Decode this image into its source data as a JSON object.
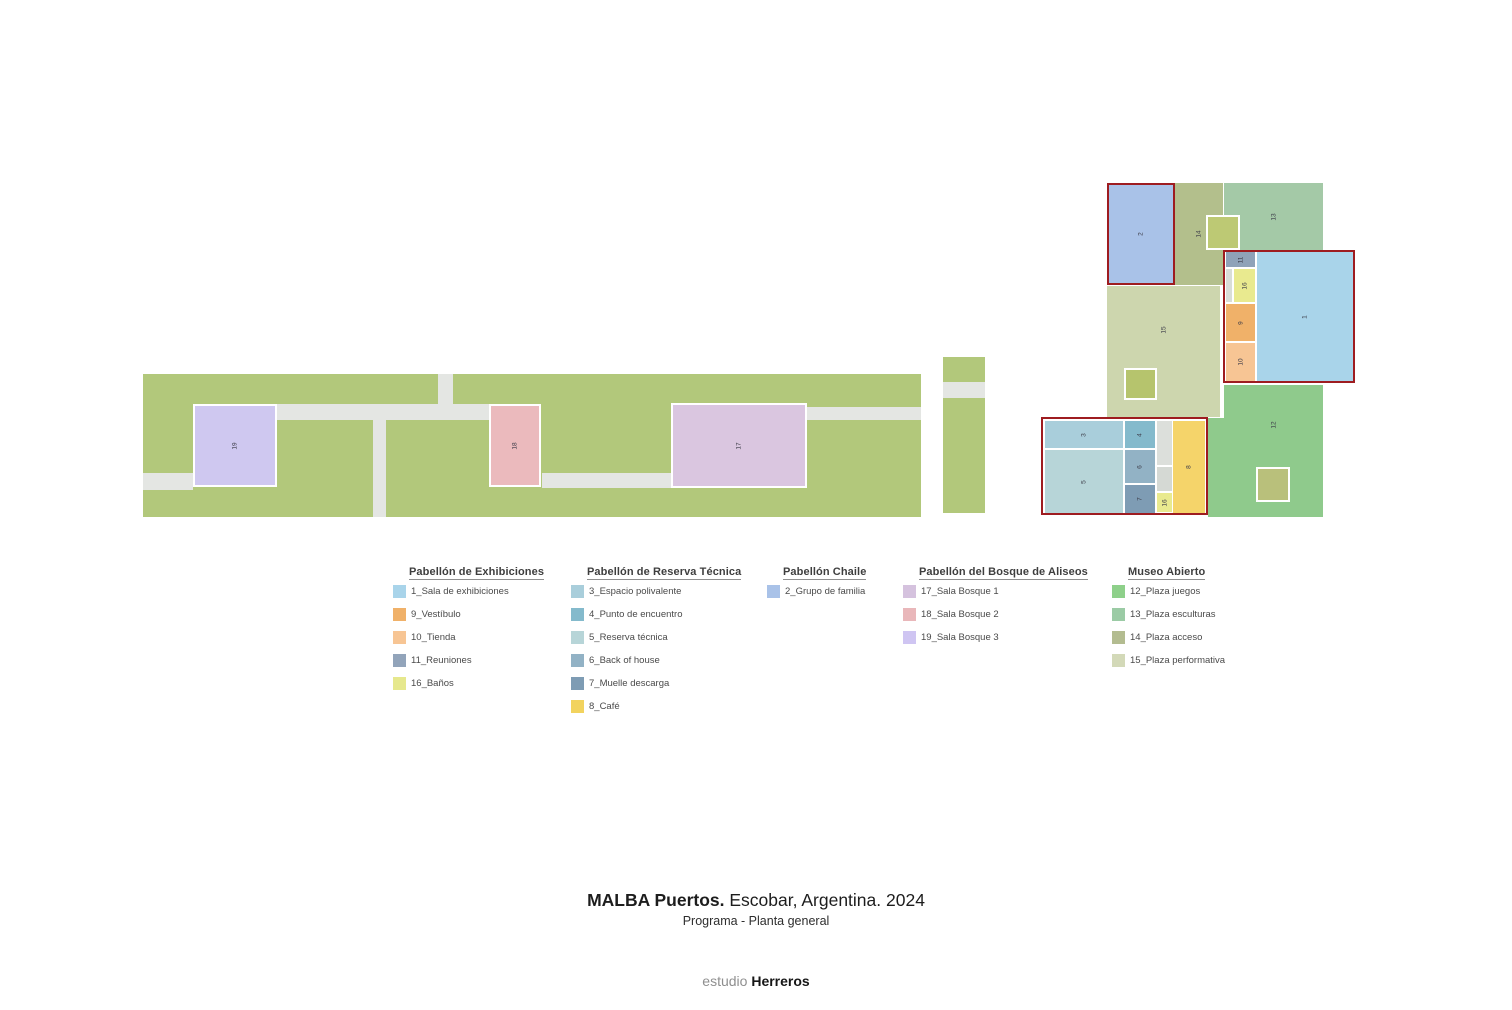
{
  "colors": {
    "bar_green": "#b2c87b",
    "path_gray": "#e4e6e3",
    "red_border": "#9e1c20",
    "white_border": "#ffffff"
  },
  "plan": {
    "rects": [
      {
        "name": "park-bar-main",
        "x": 143,
        "y": 374,
        "w": 778,
        "h": 143,
        "fill": "#b2c87b"
      },
      {
        "name": "path-horizontal-1",
        "x": 277,
        "y": 404,
        "w": 213,
        "h": 16,
        "fill": "#e4e6e3"
      },
      {
        "name": "path-horizontal-2",
        "x": 807,
        "y": 407,
        "w": 114,
        "h": 13,
        "fill": "#e4e6e3"
      },
      {
        "name": "path-horizontal-3",
        "x": 542,
        "y": 473,
        "w": 129,
        "h": 15,
        "fill": "#e4e6e3"
      },
      {
        "name": "path-vertical-1",
        "x": 373,
        "y": 420,
        "w": 13,
        "h": 97,
        "fill": "#e4e6e3"
      },
      {
        "name": "path-vertical-2",
        "x": 438,
        "y": 374,
        "w": 15,
        "h": 46,
        "fill": "#e4e6e3"
      },
      {
        "name": "path-stub-left",
        "x": 143,
        "y": 473,
        "w": 50,
        "h": 17,
        "fill": "#e4e6e3"
      },
      {
        "name": "block-sala-bosque-3",
        "x": 193,
        "y": 404,
        "w": 84,
        "h": 83,
        "fill": "#cfc8f0",
        "border": "white",
        "label": "19"
      },
      {
        "name": "block-sala-bosque-2",
        "x": 489,
        "y": 404,
        "w": 52,
        "h": 83,
        "fill": "#ebbabd",
        "border": "white",
        "label": "18"
      },
      {
        "name": "block-sala-bosque-1",
        "x": 671,
        "y": 403,
        "w": 136,
        "h": 85,
        "fill": "#dac6e0",
        "border": "white",
        "label": "17"
      },
      {
        "name": "park-strip-top",
        "x": 943,
        "y": 357,
        "w": 42,
        "h": 25,
        "fill": "#b2c87b"
      },
      {
        "name": "park-strip-gap",
        "x": 943,
        "y": 382,
        "w": 42,
        "h": 16,
        "fill": "#e4e6e3"
      },
      {
        "name": "park-strip-tall",
        "x": 943,
        "y": 398,
        "w": 42,
        "h": 115,
        "fill": "#b2c87b"
      },
      {
        "name": "block-plaza-acceso",
        "x": 1174,
        "y": 183,
        "w": 49,
        "h": 102,
        "fill": "#b3bf8c",
        "label": "14"
      },
      {
        "name": "block-plaza-esculturas",
        "x": 1224,
        "y": 183,
        "w": 99,
        "h": 67,
        "fill": "#a4c9a7",
        "label": "13"
      },
      {
        "name": "block-plaza-performativa",
        "x": 1107,
        "y": 286,
        "w": 113,
        "h": 131,
        "fill": "#cdd6ae",
        "label": "15",
        "label_dy": -22
      },
      {
        "name": "block-plaza-juegos",
        "x": 1224,
        "y": 385,
        "w": 99,
        "h": 132,
        "fill": "#8fca8c",
        "label": "12",
        "label_dy": -26
      },
      {
        "name": "block-plaza-juegos-ext",
        "x": 1208,
        "y": 418,
        "w": 16,
        "h": 99,
        "fill": "#8fca8c"
      },
      {
        "name": "square-plaza-acceso",
        "x": 1206,
        "y": 215,
        "w": 34,
        "h": 35,
        "fill": "#bdc974",
        "border": "white"
      },
      {
        "name": "square-plaza-performativa",
        "x": 1124,
        "y": 368,
        "w": 33,
        "h": 32,
        "fill": "#b6c46d",
        "border": "white"
      },
      {
        "name": "square-plaza-juegos",
        "x": 1256,
        "y": 467,
        "w": 34,
        "h": 35,
        "fill": "#b9c07b",
        "border": "white"
      },
      {
        "name": "block-grupo-de-familia",
        "x": 1107,
        "y": 183,
        "w": 68,
        "h": 102,
        "fill": "#a9c2e8",
        "border": "red",
        "label": "2"
      },
      {
        "name": "block-reuniones",
        "x": 1226,
        "y": 252,
        "w": 29,
        "h": 15,
        "fill": "#8fa2b8",
        "label": "11"
      },
      {
        "name": "hall-gray-sliver",
        "x": 1226,
        "y": 269,
        "w": 6,
        "h": 33,
        "fill": "#d9ddd8"
      },
      {
        "name": "block-banos-norte",
        "x": 1234,
        "y": 269,
        "w": 21,
        "h": 33,
        "fill": "#e9ea8f",
        "label": "16"
      },
      {
        "name": "block-vestibulo",
        "x": 1226,
        "y": 304,
        "w": 29,
        "h": 37,
        "fill": "#f0b169",
        "label": "9"
      },
      {
        "name": "block-tienda",
        "x": 1226,
        "y": 343,
        "w": 29,
        "h": 38,
        "fill": "#f7c594",
        "label": "10"
      },
      {
        "name": "block-sala-exhibiciones",
        "x": 1257,
        "y": 252,
        "w": 96,
        "h": 129,
        "fill": "#a9d4ea",
        "label": "1"
      },
      {
        "name": "redbox-pabellon-exhibiciones",
        "x": 1223,
        "y": 250,
        "w": 132,
        "h": 133,
        "fill": "none",
        "border": "red"
      },
      {
        "name": "block-espacio-polivalente",
        "x": 1045,
        "y": 421,
        "w": 78,
        "h": 27,
        "fill": "#a9cedb",
        "label": "3"
      },
      {
        "name": "block-punto-encuentro",
        "x": 1125,
        "y": 421,
        "w": 30,
        "h": 27,
        "fill": "#84bacc",
        "label": "4"
      },
      {
        "name": "block-reserva-tecnica",
        "x": 1045,
        "y": 450,
        "w": 78,
        "h": 63,
        "fill": "#b7d5d8",
        "label": "5"
      },
      {
        "name": "block-back-of-house",
        "x": 1125,
        "y": 450,
        "w": 30,
        "h": 33,
        "fill": "#92b2c5",
        "label": "6"
      },
      {
        "name": "block-muelle-descarga",
        "x": 1125,
        "y": 485,
        "w": 30,
        "h": 28,
        "fill": "#7e9cb4",
        "label": "7"
      },
      {
        "name": "reserva-gray-a",
        "x": 1157,
        "y": 421,
        "w": 15,
        "h": 44,
        "fill": "#dcdfdb"
      },
      {
        "name": "reserva-gray-b",
        "x": 1157,
        "y": 467,
        "w": 15,
        "h": 24,
        "fill": "#d5d9d4"
      },
      {
        "name": "block-banos-sur",
        "x": 1157,
        "y": 493,
        "w": 15,
        "h": 19,
        "fill": "#e9ea8f",
        "label": "16"
      },
      {
        "name": "block-cafe",
        "x": 1173,
        "y": 421,
        "w": 32,
        "h": 92,
        "fill": "#f5d46a",
        "label": "8"
      },
      {
        "name": "redbox-pabellon-reserva",
        "x": 1041,
        "y": 417,
        "w": 167,
        "h": 98,
        "fill": "none",
        "border": "red"
      }
    ]
  },
  "legend": {
    "columns": [
      {
        "title": "Pabellón de Exhibiciones",
        "left": 393,
        "items": [
          {
            "label": "1_Sala de exhibiciones",
            "color": "#a9d4ea"
          },
          {
            "label": "9_Vestíbulo",
            "color": "#f0b169"
          },
          {
            "label": "10_Tienda",
            "color": "#f7c594"
          },
          {
            "label": "11_Reuniones",
            "color": "#92a4ba"
          },
          {
            "label": "16_Baños",
            "color": "#e6e88d"
          }
        ]
      },
      {
        "title": "Pabellón de Reserva Técnica",
        "left": 571,
        "items": [
          {
            "label": "3_Espacio polivalente",
            "color": "#a9cedb"
          },
          {
            "label": "4_Punto de encuentro",
            "color": "#84bacc"
          },
          {
            "label": "5_Reserva técnica",
            "color": "#b7d5d8"
          },
          {
            "label": "6_Back of house",
            "color": "#92b2c5"
          },
          {
            "label": "7_Muelle descarga",
            "color": "#7e9cb4"
          },
          {
            "label": "8_Café",
            "color": "#f2d35e"
          }
        ]
      },
      {
        "title": "Pabellón Chaile",
        "left": 767,
        "items": [
          {
            "label": "2_Grupo de familia",
            "color": "#a9c2e8"
          }
        ]
      },
      {
        "title": "Pabellón del Bosque de Aliseos",
        "left": 903,
        "items": [
          {
            "label": "17_Sala Bosque 1",
            "color": "#d5c2de"
          },
          {
            "label": "18_Sala Bosque 2",
            "color": "#e9b7ba"
          },
          {
            "label": "19_Sala Bosque 3",
            "color": "#cfc5f2"
          }
        ]
      },
      {
        "title": "Museo Abierto",
        "left": 1112,
        "items": [
          {
            "label": "12_Plaza juegos",
            "color": "#8ed08a"
          },
          {
            "label": "13_Plaza esculturas",
            "color": "#9bcba5"
          },
          {
            "label": "14_Plaza acceso",
            "color": "#b3bc90"
          },
          {
            "label": "15_Plaza performativa",
            "color": "#d3d9b8"
          }
        ]
      }
    ]
  },
  "title": {
    "bold": "MALBA Puertos.",
    "rest": " Escobar, Argentina. 2024",
    "subtitle": "Programa - Planta general"
  },
  "footer": {
    "light": "estudio",
    "bold": "Herreros"
  }
}
